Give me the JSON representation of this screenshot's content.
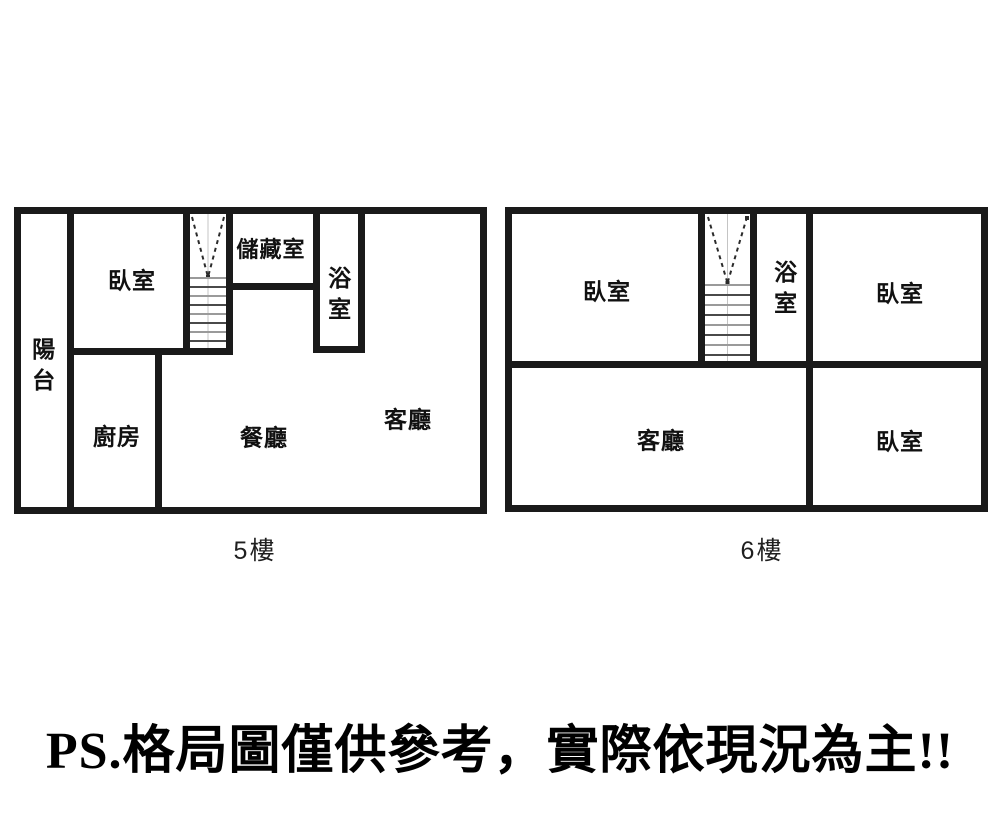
{
  "colors": {
    "wall": "#1a1a1a",
    "background": "#ffffff",
    "text": "#111111"
  },
  "icons": {
    "staircase": "v-arrow-with-steps"
  },
  "floor5": {
    "caption": "5樓",
    "rooms": [
      {
        "name": "balcony",
        "label": "陽台"
      },
      {
        "name": "bedroom",
        "label": "臥室"
      },
      {
        "name": "storage",
        "label": "儲藏室"
      },
      {
        "name": "bathroom",
        "label": "浴室"
      },
      {
        "name": "kitchen",
        "label": "廚房"
      },
      {
        "name": "dining",
        "label": "餐廳"
      },
      {
        "name": "living",
        "label": "客廳"
      }
    ]
  },
  "floor6": {
    "caption": "6樓",
    "rooms": [
      {
        "name": "bedroom-top-left",
        "label": "臥室"
      },
      {
        "name": "bathroom",
        "label": "浴室"
      },
      {
        "name": "bedroom-top-right",
        "label": "臥室"
      },
      {
        "name": "living",
        "label": "客廳"
      },
      {
        "name": "bedroom-bottom-right",
        "label": "臥室"
      }
    ]
  },
  "disclaimer": "PS.格局圖僅供參考，實際依現況為主!!"
}
